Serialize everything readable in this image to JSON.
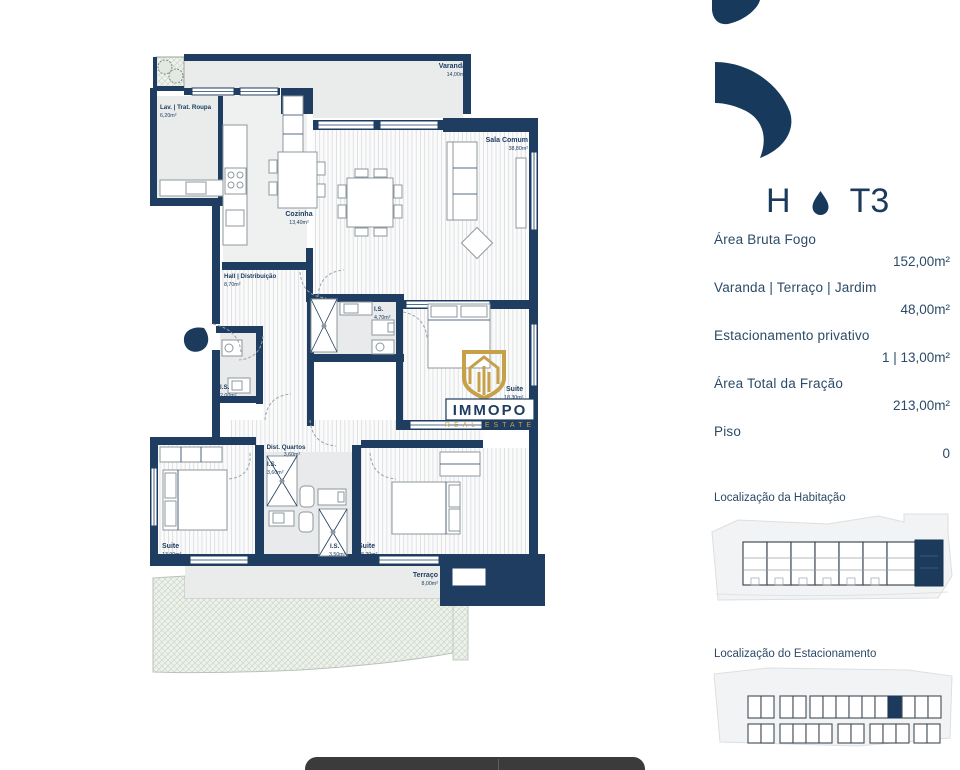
{
  "colors": {
    "navy": "#1c3a5c",
    "wall": "#1e3d60",
    "gold": "#c09a45",
    "floor": "#eaecec",
    "garden": "#eef2ec",
    "dock_bar": "#3b3b3b"
  },
  "header": {
    "unit": "H",
    "typology": "T3"
  },
  "details": [
    {
      "label": "Área Bruta Fogo",
      "value": "152,00m²"
    },
    {
      "label": "Varanda | Terraço | Jardim",
      "value": "48,00m²"
    },
    {
      "label": "Estacionamento privativo",
      "value": "1 | 13,00m²"
    },
    {
      "label": "Área Total da Fração",
      "value": "213,00m²"
    },
    {
      "label": "Piso",
      "value": "0"
    }
  ],
  "sections": {
    "habitacao_title": "Localização da Habitação",
    "estacionamento_title": "Localização do Estacionamento"
  },
  "floorplan": {
    "watermark": {
      "brand": "IMMOPO",
      "tagline": "REAL ESTATE"
    },
    "rooms": {
      "varanda": {
        "name": "Varanda",
        "area": "14,00m²"
      },
      "lav": {
        "name": "Lav. | Trat. Roupa",
        "area": "6,20m²"
      },
      "sala": {
        "name": "Sala Comum",
        "area": "38,80m²"
      },
      "cozinha": {
        "name": "Cozinha",
        "area": "13,40m²"
      },
      "hall": {
        "name": "Hall | Distribuição",
        "area": "8,70m²"
      },
      "is_470": {
        "name": "I.S.",
        "area": "4,70m²"
      },
      "suite_1830": {
        "name": "Suite",
        "area": "18,30m²"
      },
      "is_200": {
        "name": "I.S.",
        "area": "2,00m²"
      },
      "dist_quartos": {
        "name": "Dist. Quartos",
        "area": "3,60m²"
      },
      "is_360": {
        "name": "I.S.",
        "area": "3,60m²"
      },
      "suite_1390": {
        "name": "Suite",
        "area": "13,90m²"
      },
      "is_350": {
        "name": "I.S.",
        "area": "3,50m²"
      },
      "suite_1820": {
        "name": "Suite",
        "area": "18,20m²"
      },
      "terraco": {
        "name": "Terraço",
        "area": "8,00m²"
      }
    }
  }
}
